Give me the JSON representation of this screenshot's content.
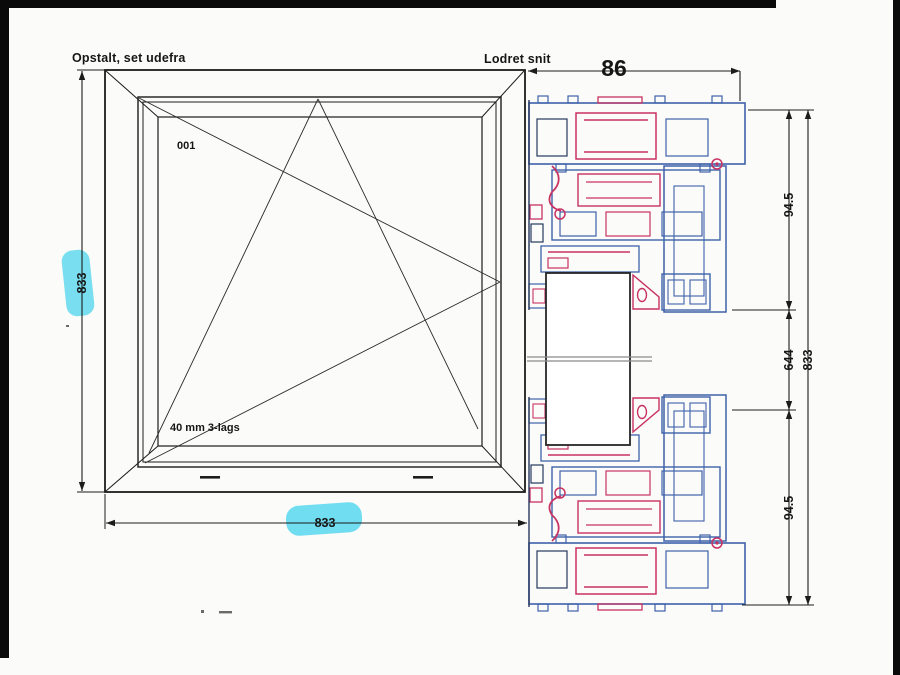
{
  "document": {
    "type_note": "scanned window technical drawing"
  },
  "elevation": {
    "title": "Opstalt, set udefra",
    "item_label": "001",
    "glazing_label": "40 mm 3-lags",
    "dim_height": "833",
    "dim_width": "833"
  },
  "section": {
    "title": "Lodret snit",
    "dim_depth": "86",
    "dim_top_profile": "94.5",
    "dim_glass": "644",
    "dim_total": "833",
    "dim_bottom_profile": "94.5"
  },
  "colors": {
    "profile_blue": "#3f62aa",
    "profile_red": "#c93362",
    "highlight_cyan": "#57d7ee",
    "line_black": "#1c1c1c",
    "break_gray": "#8b8b8b"
  }
}
